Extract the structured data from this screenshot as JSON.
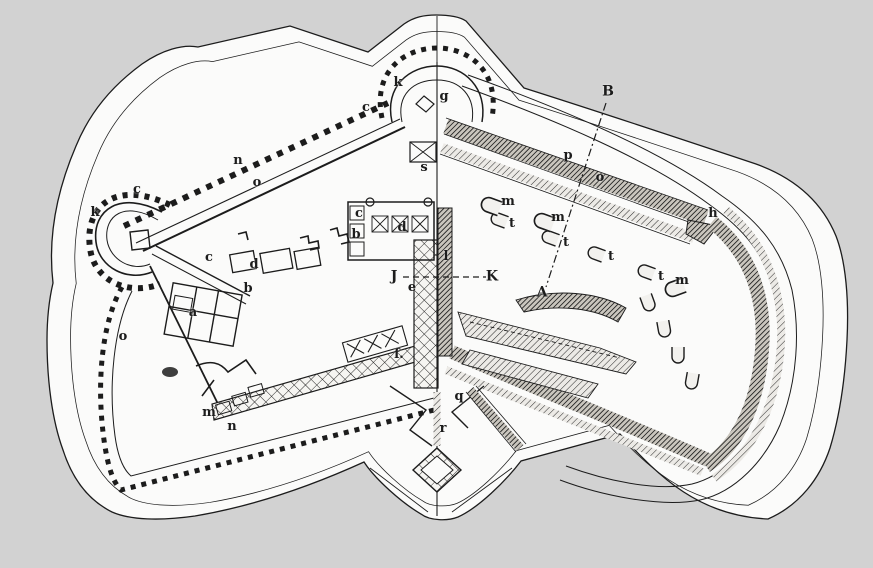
{
  "figure": {
    "kind": "fortification-plan-engraving",
    "description": "Engraved plan of a polygonal fort: left half shown as a ground plan, right half as a shaded bird's-eye view, divided by a vertical centre line",
    "background_color": "#d2d2d2",
    "paper_color": "#fbfbfa",
    "ink_color": "#1c1c1c"
  },
  "section_lines": [
    {
      "name": "J-K-section",
      "style": "dashed",
      "x1": 403,
      "y1": 277,
      "x2": 486,
      "y2": 277
    },
    {
      "name": "B-A-section",
      "style": "dash-dot",
      "x1": 606,
      "y1": 103,
      "x2": 546,
      "y2": 287
    }
  ],
  "labels": [
    {
      "text": "k",
      "x": 95,
      "y": 213
    },
    {
      "text": "c",
      "x": 137,
      "y": 190
    },
    {
      "text": "n",
      "x": 238,
      "y": 161
    },
    {
      "text": "o",
      "x": 257,
      "y": 183
    },
    {
      "text": "k",
      "x": 398,
      "y": 83
    },
    {
      "text": "c",
      "x": 366,
      "y": 108
    },
    {
      "text": "g",
      "x": 444,
      "y": 97
    },
    {
      "text": "B",
      "x": 608,
      "y": 92
    },
    {
      "text": "p",
      "x": 568,
      "y": 156
    },
    {
      "text": "o",
      "x": 600,
      "y": 178
    },
    {
      "text": "s",
      "x": 424,
      "y": 168
    },
    {
      "text": "c",
      "x": 359,
      "y": 214
    },
    {
      "text": "b",
      "x": 356,
      "y": 235
    },
    {
      "text": "d",
      "x": 402,
      "y": 228
    },
    {
      "text": "h",
      "x": 713,
      "y": 214
    },
    {
      "text": "m",
      "x": 508,
      "y": 202
    },
    {
      "text": "m",
      "x": 558,
      "y": 218
    },
    {
      "text": "t",
      "x": 512,
      "y": 224
    },
    {
      "text": "t",
      "x": 566,
      "y": 243
    },
    {
      "text": "t",
      "x": 611,
      "y": 257
    },
    {
      "text": "t",
      "x": 661,
      "y": 277
    },
    {
      "text": "m",
      "x": 682,
      "y": 281
    },
    {
      "text": "l",
      "x": 446,
      "y": 257
    },
    {
      "text": "J",
      "x": 394,
      "y": 277
    },
    {
      "text": "K",
      "x": 492,
      "y": 277
    },
    {
      "text": "e",
      "x": 412,
      "y": 288
    },
    {
      "text": "A",
      "x": 542,
      "y": 293
    },
    {
      "text": "c",
      "x": 209,
      "y": 258
    },
    {
      "text": "d",
      "x": 254,
      "y": 265
    },
    {
      "text": "b",
      "x": 248,
      "y": 289
    },
    {
      "text": "a",
      "x": 193,
      "y": 313
    },
    {
      "text": "o",
      "x": 123,
      "y": 337
    },
    {
      "text": "m",
      "x": 209,
      "y": 413
    },
    {
      "text": "n",
      "x": 232,
      "y": 427
    },
    {
      "text": "f.",
      "x": 399,
      "y": 355
    },
    {
      "text": "q",
      "x": 459,
      "y": 397
    },
    {
      "text": "r",
      "x": 443,
      "y": 429
    }
  ]
}
